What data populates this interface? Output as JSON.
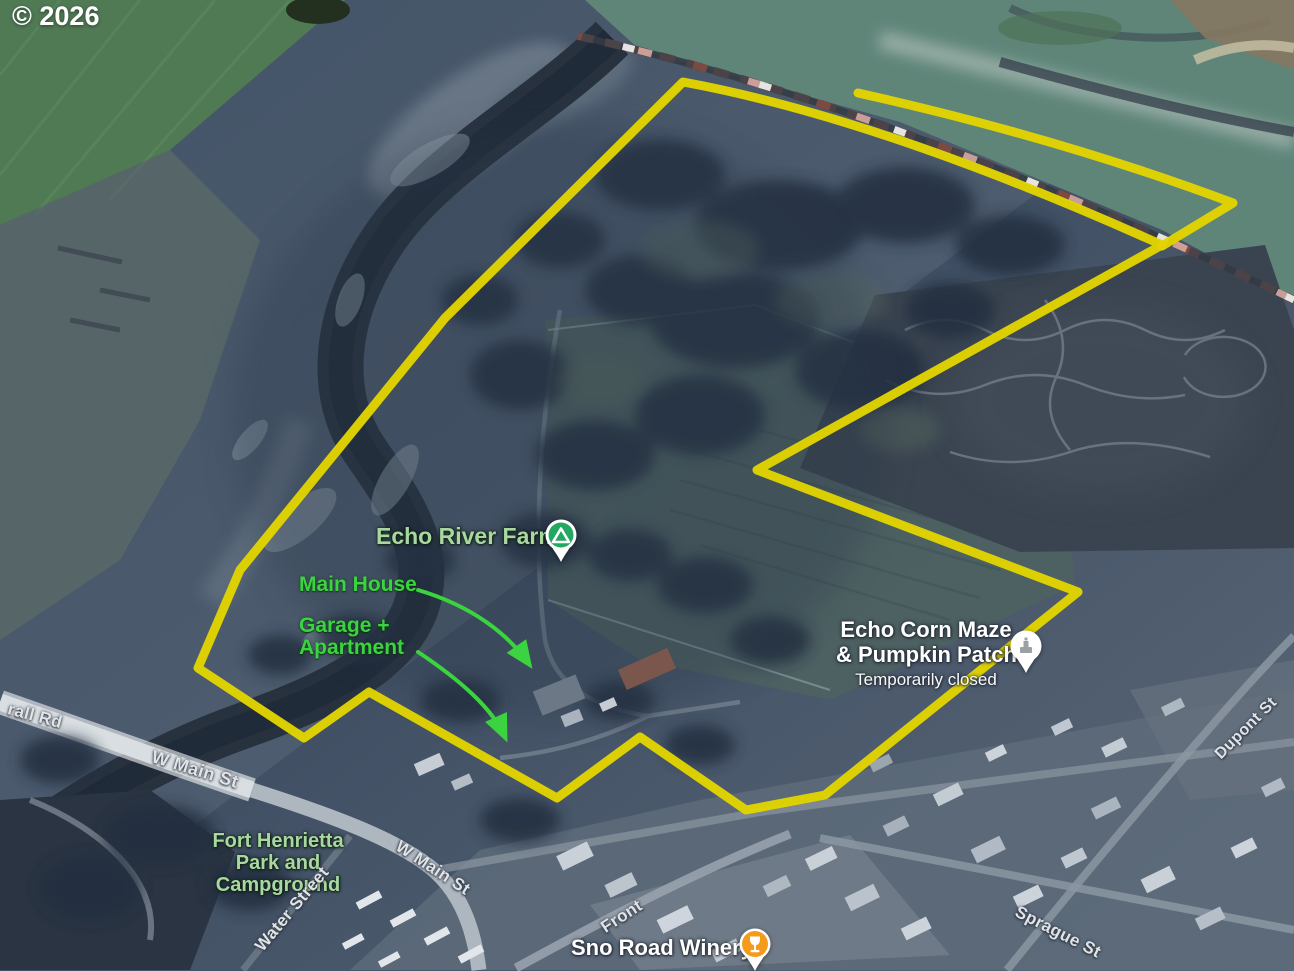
{
  "attribution": {
    "copyright": "© 2026"
  },
  "annotations": {
    "main_house": "Main House",
    "garage_line1": "Garage +",
    "garage_line2": "Apartment"
  },
  "places": {
    "echo_river_farms": {
      "name": "Echo River Farms",
      "pin_icon": "campground-pin"
    },
    "echo_corn_maze": {
      "name_line1": "Echo Corn Maze",
      "name_line2": "& Pumpkin Patch",
      "status": "Temporarily closed",
      "pin_icon": "attraction-pin"
    },
    "fort_henrietta": {
      "name_line1": "Fort Henrietta",
      "name_line2": "Park and",
      "name_line3": "Campground"
    },
    "sno_road_winery": {
      "name": "Sno Road Winery",
      "pin_icon": "wine-glass-pin"
    }
  },
  "streets": {
    "rall_rd": "rall Rd",
    "w_main_st_bridge": "W Main St",
    "w_main_st": "W Main St",
    "water_street": "Water Street",
    "front": "Front",
    "sprague_st": "Sprague St",
    "dupont_st": "Dupont St"
  },
  "colors": {
    "boundary-yellow": "#e2d400",
    "annotation-green": "#3bd33f",
    "place-label-green": "#a8d89f",
    "street-label": "#dfe4e9",
    "white-label": "#ffffff",
    "pin-green": "#23a861",
    "pin-orange": "#f59b1b"
  }
}
